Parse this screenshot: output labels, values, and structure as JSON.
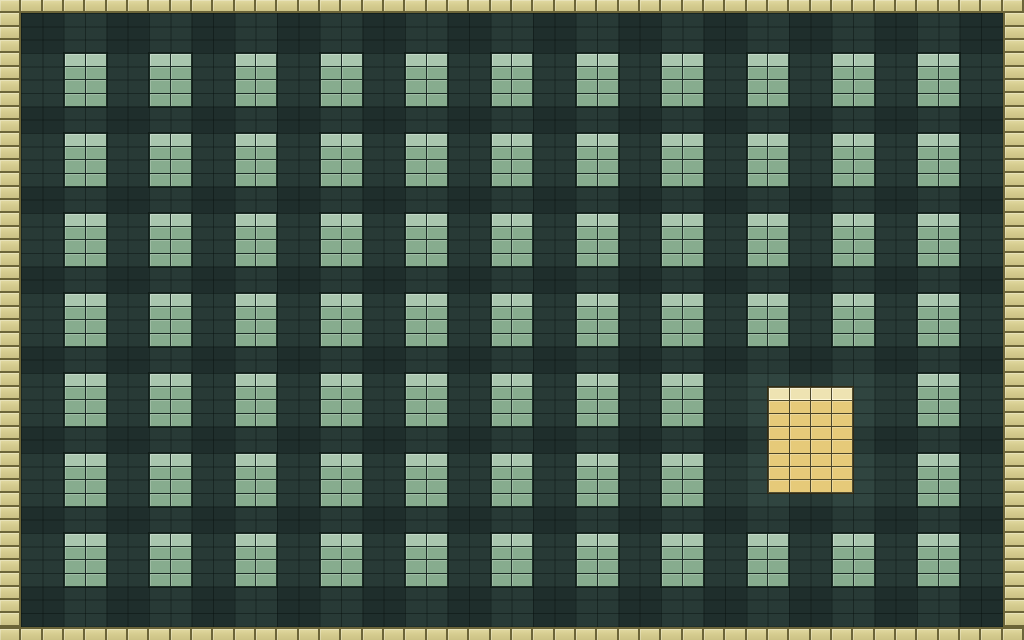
{
  "app": {
    "name": "pixel-block-puzzle-board"
  },
  "board": {
    "grid_columns": 48,
    "grid_rows": 48,
    "border_thickness_cells": 1,
    "blocks": {
      "rows": 7,
      "cols": 11,
      "first_cell_col": 3,
      "first_cell_row": 4,
      "width_cells": 2,
      "height_cells": 4,
      "pitch_cols": 4,
      "pitch_rows": 6,
      "count_visible": 73
    },
    "missing_blocks": [
      {
        "row": 5,
        "col": 9
      },
      {
        "row": 5,
        "col": 10
      },
      {
        "row": 6,
        "col": 9
      },
      {
        "row": 6,
        "col": 10
      }
    ],
    "active_block": {
      "cell_col": 36,
      "cell_row": 29,
      "width_cells": 4,
      "height_cells": 8
    }
  },
  "colors": {
    "border_tile": "#d6cd90",
    "border_tile_light": "#e1d9a2",
    "border_tile_dark": "#cbc285",
    "border_tile_line": "#6b6438",
    "field_base": "#1f2e2c",
    "field_band": "rgba(136,186,166,0.085)",
    "grid_line": "rgba(5,12,10,0.42)",
    "block_body": "#87ac8e",
    "block_top": "#a9c6ae",
    "block_line": "rgba(23,40,31,0.55)",
    "block_outline": "rgba(11,21,17,0.65)",
    "active_body": "#e6ca79",
    "active_top": "#eee3b2",
    "active_line": "rgba(112,87,38,0.55)",
    "active_outline": "rgba(52,41,16,0.8)",
    "active_top_glow": "rgba(255,250,219,0.9)"
  }
}
